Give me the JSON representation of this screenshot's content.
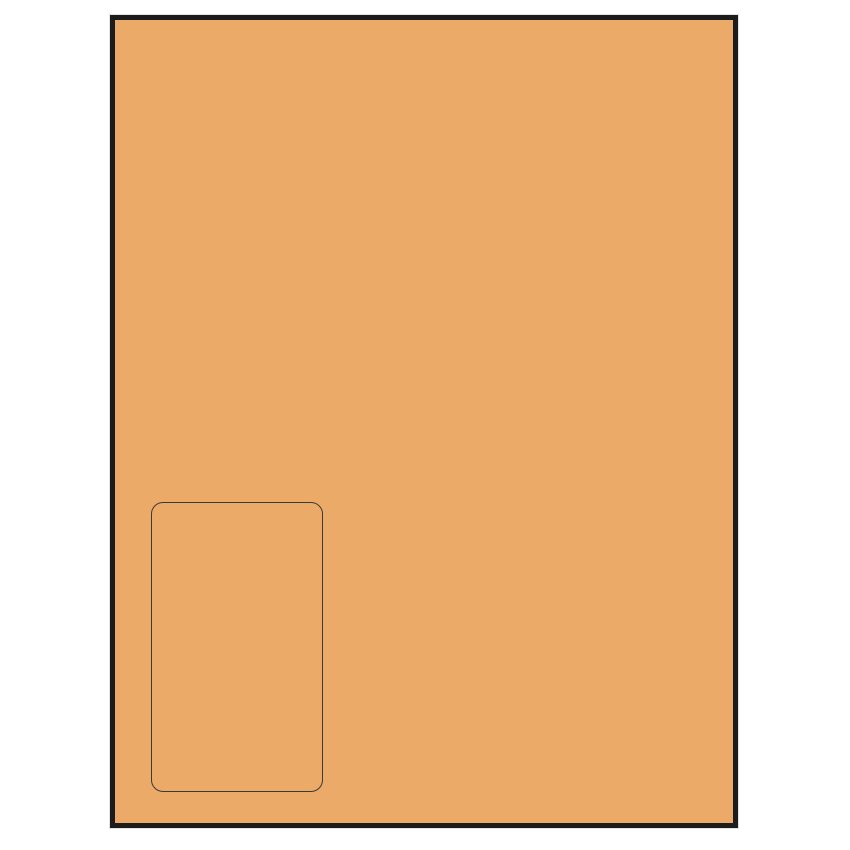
{
  "canvas": {
    "background_color": "#ffffff"
  },
  "sheet": {
    "description": "blank label sheet preview",
    "fill_color": "#EBAA67",
    "border_color": "#1C1C1C",
    "shadow_color": "#E2E2E2"
  },
  "label": {
    "description": "single rounded-rectangle label outline, bottom-left of sheet",
    "border_color": "#3A3A3A",
    "fill_color": "transparent"
  }
}
